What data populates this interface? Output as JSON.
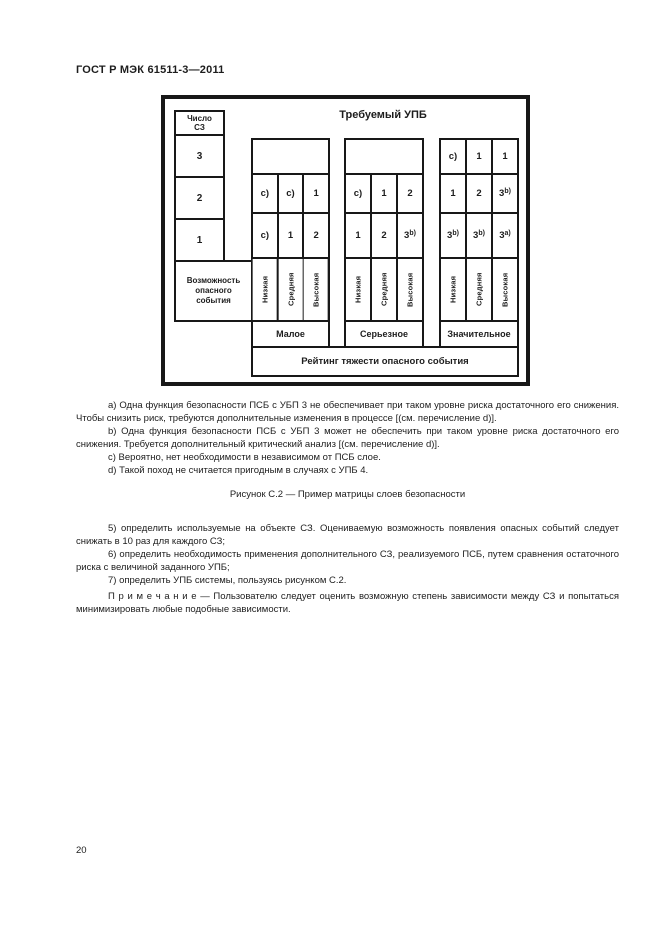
{
  "page": {
    "header_title": "ГОСТ Р МЭК 61511-3—2011",
    "page_number": "20"
  },
  "figure": {
    "title": "Требуемый УПБ",
    "layer_count": {
      "header": "Число\nСЗ",
      "cells": [
        "3",
        "2",
        "1"
      ]
    },
    "possibility_label": "Возможность опасного события",
    "likelihood_labels": [
      "Низкая",
      "Средняя",
      "Высокая"
    ],
    "severity_label": "Рейтинг тяжести опасного события",
    "groups": [
      {
        "label": "Малое",
        "top_merged": true,
        "top_cells": [],
        "cells": [
          [
            "c)",
            "c)",
            "1"
          ],
          [
            "c)",
            "1",
            "2"
          ]
        ]
      },
      {
        "label": "Серьезное",
        "top_merged": true,
        "top_cells": [],
        "cells": [
          [
            "c)",
            "1",
            "2"
          ],
          [
            "1",
            "2",
            "3^b)"
          ]
        ]
      },
      {
        "label": "Значительное",
        "top_merged": false,
        "top_cells": [
          "c)",
          "1",
          "1"
        ],
        "cells": [
          [
            "1",
            "2",
            "3^b)"
          ],
          [
            "3^b)",
            "3^b)",
            "3^a)"
          ]
        ]
      }
    ]
  },
  "footnotes": [
    "a)  Одна функция безопасности ПСБ с УБП 3 не обеспечивает при таком уровне риска достаточного его снижения. Чтобы снизить риск, требуются дополнительные изменения в процессе [(см. перечисление d)].",
    "b)  Одна функция безопасности ПСБ с УБП 3 может не обеспечить при таком уровне риска достаточного его снижения. Требуется дополнительный критический анализ [(см. перечисление d)].",
    "c)  Вероятно, нет необходимости в независимом от ПСБ слое.",
    "d)  Такой поход не считается пригодным в случаях с УПБ 4."
  ],
  "caption": "Рисунок  С.2 — Пример матрицы слоев безопасности",
  "list_items": [
    "5)  определить используемые на объекте СЗ. Оцениваемую возможность появления опасных событий следует снижать в 10 раз для каждого СЗ;",
    "6)  определить необходимость применения дополнительного СЗ, реализуемого ПСБ, путем сравнения остаточного риска с величиной заданного УПБ;",
    "7)  определить УПБ системы, пользуясь рисунком С.2."
  ],
  "note": "П р и м е ч а н и е — Пользователю следует оценить возможную степень зависимости между СЗ и попытаться минимизировать любые подобные зависимости."
}
